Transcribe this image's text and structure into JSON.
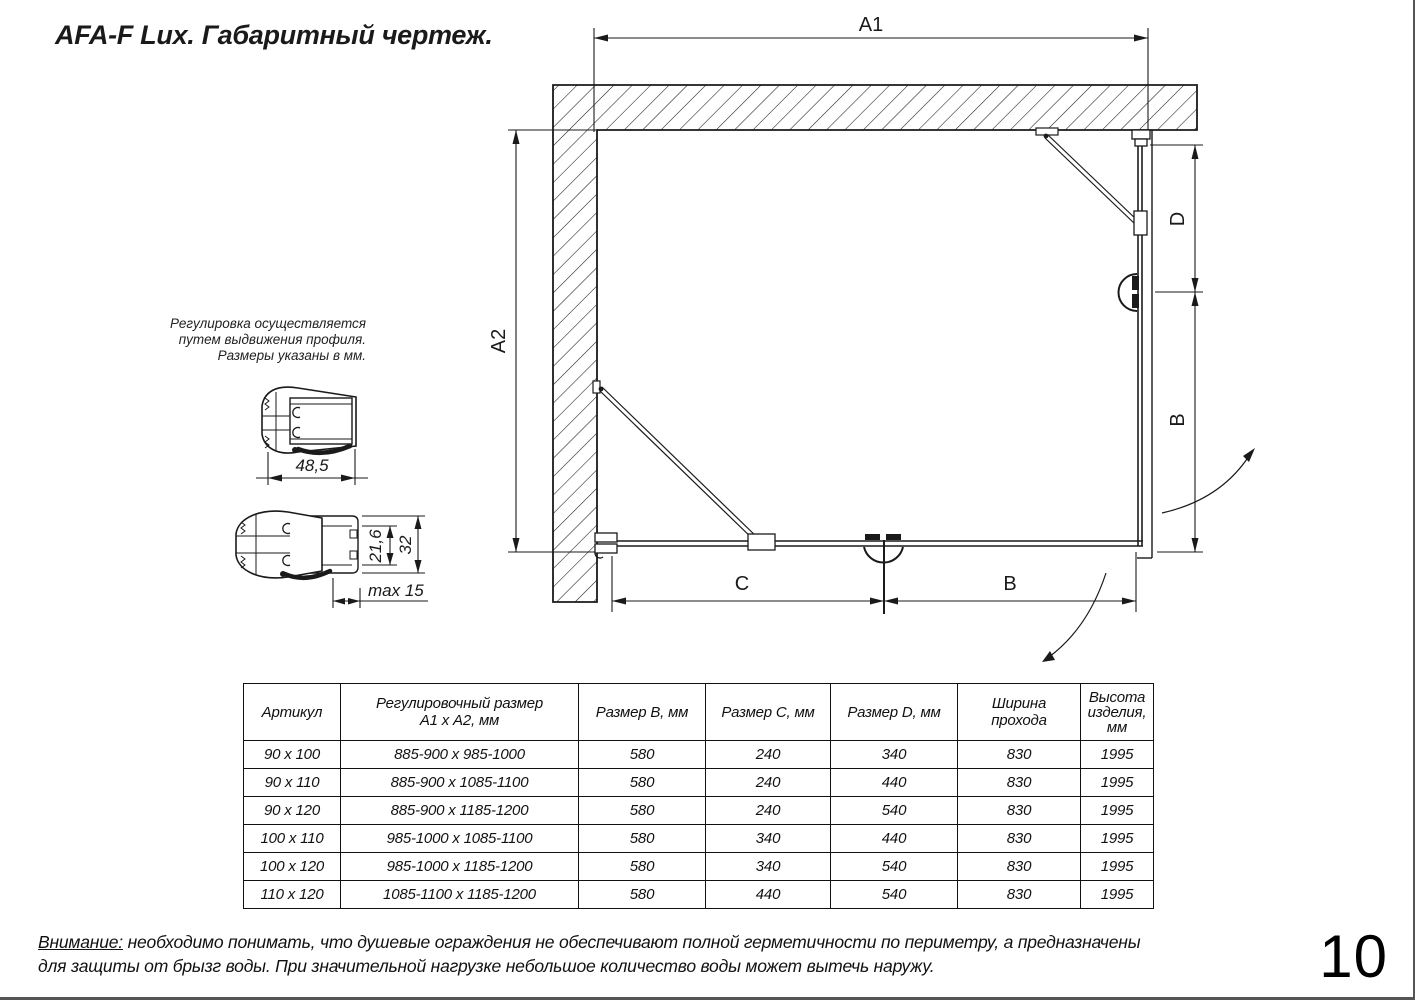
{
  "title": "AFA-F Lux. Габаритный чертеж.",
  "page_number": "10",
  "drawing_labels": {
    "a1": "A1",
    "a2": "A2",
    "d": "D",
    "b_side": "B",
    "c": "C",
    "b_front": "B"
  },
  "profile_note": {
    "line1": "Регулировка осуществляется",
    "line2": "путем выдвижения профиля.",
    "line3": "Размеры указаны в мм."
  },
  "profile_dims": {
    "width": "48,5",
    "inner_height": "21,6",
    "outer_height": "32",
    "max_extension": "max 15"
  },
  "table": {
    "headers": {
      "col1": "Артикул",
      "col2a": "Регулировочный размер",
      "col2b": "А1 х А2, мм",
      "col3": "Размер В, мм",
      "col4": "Размер С, мм",
      "col5": "Размер D, мм",
      "col6a": "Ширина",
      "col6b": "прохода",
      "col7a": "Высота",
      "col7b": "изделия,",
      "col7c": "мм"
    },
    "rows": [
      [
        "90 x 100",
        "885-900 x 985-1000",
        "580",
        "240",
        "340",
        "830",
        "1995"
      ],
      [
        "90 x 110",
        "885-900 x 1085-1100",
        "580",
        "240",
        "440",
        "830",
        "1995"
      ],
      [
        "90 x 120",
        "885-900 x 1185-1200",
        "580",
        "240",
        "540",
        "830",
        "1995"
      ],
      [
        "100 x 110",
        "985-1000 x 1085-1100",
        "580",
        "340",
        "440",
        "830",
        "1995"
      ],
      [
        "100 x 120",
        "985-1000 x 1185-1200",
        "580",
        "340",
        "540",
        "830",
        "1995"
      ],
      [
        "110 x 120",
        "1085-1100 x 1185-1200",
        "580",
        "440",
        "540",
        "830",
        "1995"
      ]
    ]
  },
  "warning": {
    "label": "Внимание:",
    "line1_rest": " необходимо понимать, что душевые ограждения не обеспечивают полной герметичности по периметру, а предназначены",
    "line2": "для защиты от брызг воды. При значительной нагрузке небольшое количество воды может вытечь наружу."
  },
  "colors": {
    "line": "#1a1a1a",
    "background": "#ffffff"
  }
}
